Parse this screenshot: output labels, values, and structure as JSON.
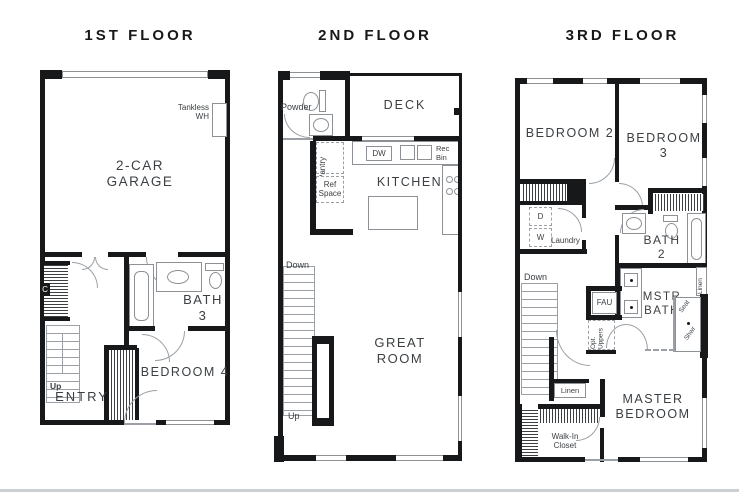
{
  "divider_color": "#cbd0d3",
  "floor1": {
    "title": "1ST FLOOR",
    "garage": "2-CAR\nGARAGE",
    "tankless": "Tankless\nWH",
    "closet_c": "C",
    "bath3": "BATH\n3",
    "bedroom4": "BEDROOM 4",
    "entry": "ENTRY",
    "up": "Up"
  },
  "floor2": {
    "title": "2ND FLOOR",
    "powder": "Powder",
    "deck": "DECK",
    "pantry": "Pantry",
    "ref_space": "Ref\nSpace",
    "dw": "DW",
    "rec_bin": "Rec\nBin",
    "kitchen": "KITCHEN",
    "great_room": "GREAT\nROOM",
    "down": "Down",
    "up": "Up"
  },
  "floor3": {
    "title": "3RD FLOOR",
    "bedroom2": "BEDROOM 2",
    "bedroom3": "BEDROOM 3",
    "laundry_d": "D",
    "laundry_w": "W",
    "laundry": "Laundry",
    "bath2": "BATH\n2",
    "down": "Down",
    "fau": "FAU",
    "opt_uppers": "Opt. Uppers",
    "mstr_bath": "MSTR\nBATH",
    "linen_upper": "Linen",
    "seat": "Seat",
    "shower": "Shwr",
    "linen_lower": "Linen",
    "walk_in": "Walk-In\nCloset",
    "master": "MASTER\nBEDROOM"
  }
}
